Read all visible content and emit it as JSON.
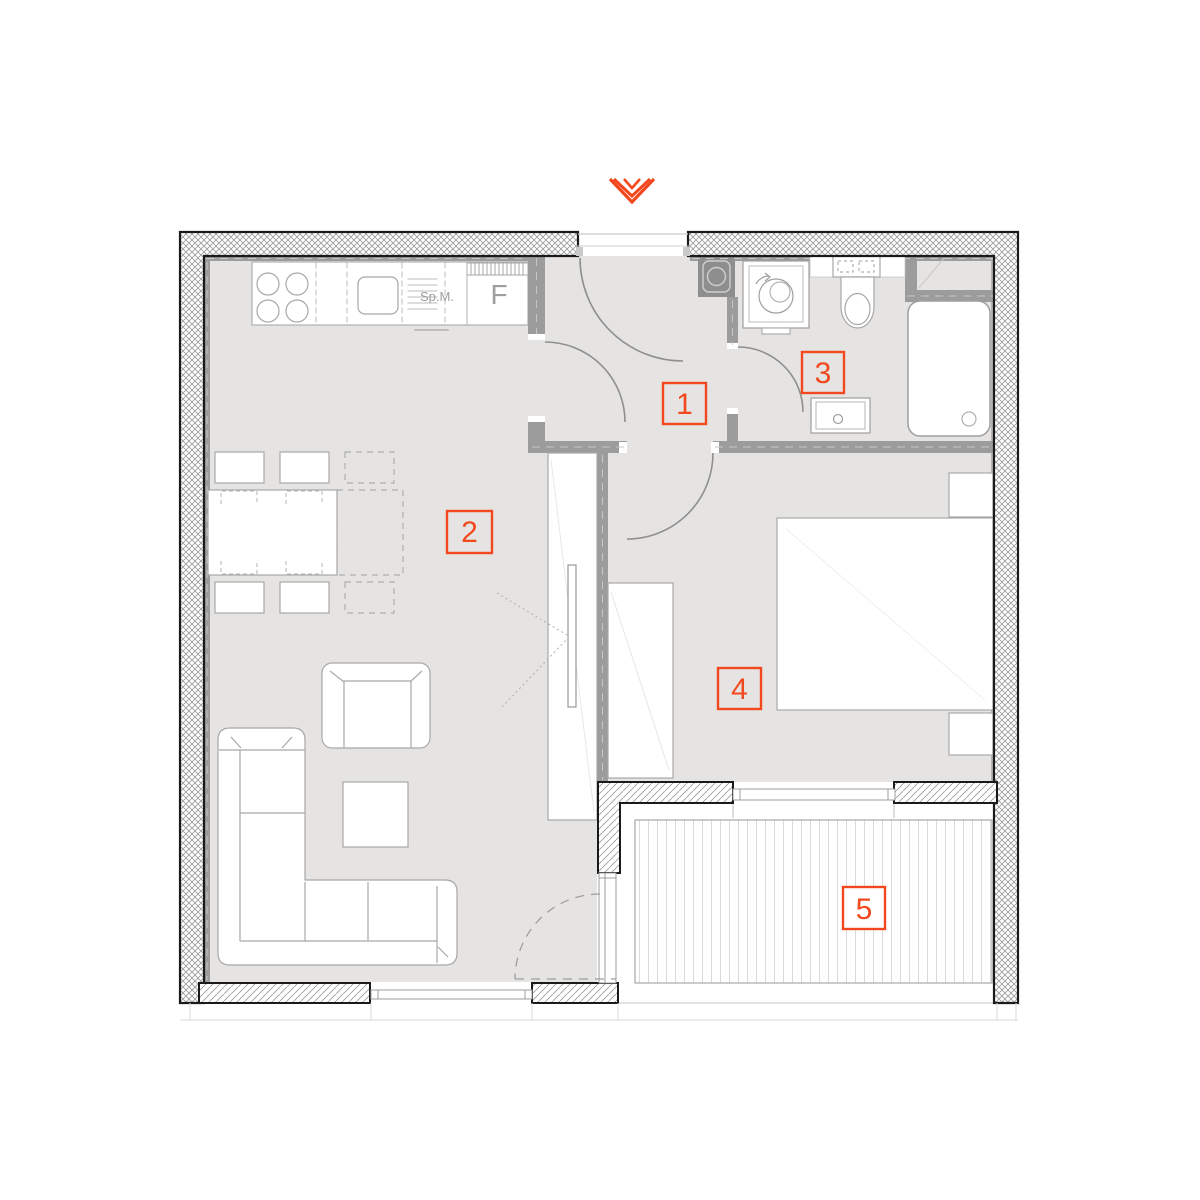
{
  "logo": {
    "icon": "triple-chevron-down-icon",
    "color": "#f2481e"
  },
  "rooms": [
    {
      "label": "1"
    },
    {
      "label": "2"
    },
    {
      "label": "3"
    },
    {
      "label": "4"
    },
    {
      "label": "5"
    }
  ],
  "kitchen": {
    "dishwasher_label": "Sp.M.",
    "fridge_label": "F"
  },
  "colors": {
    "accent_orange": "#f2481e",
    "interior_wall_gray": "#9c9c9c",
    "floor_gray": "#e5e4e3",
    "furniture_outline_gray": "#a8a8a8",
    "exterior_wall_hatch_gray": "#9e9e9e"
  }
}
